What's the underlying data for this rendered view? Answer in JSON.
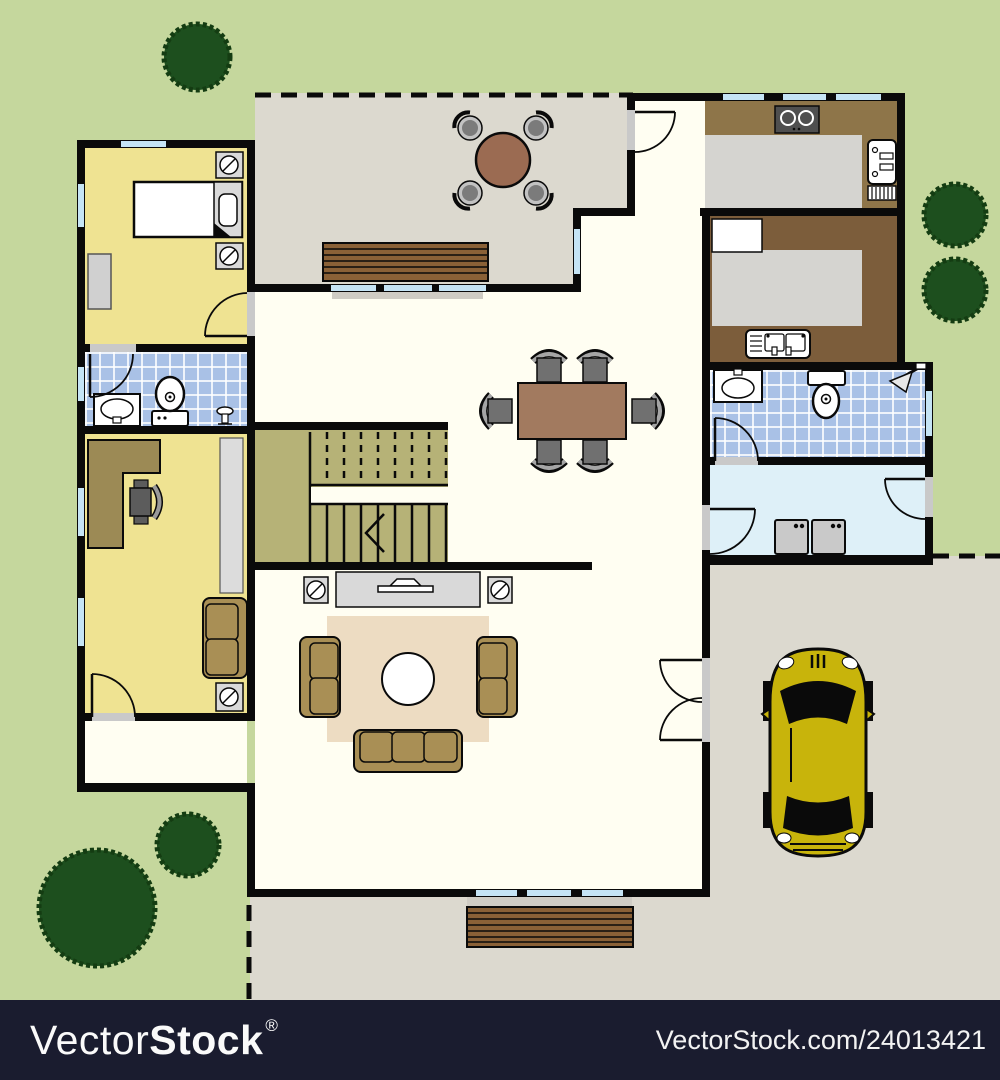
{
  "watermark": {
    "brand_light": "Vector",
    "brand_bold": "Stock",
    "registered_mark": "®",
    "site_credit": "VectorStock.com/24013421"
  },
  "colors": {
    "yard-green": "#c5d79d",
    "tree-green": "#1d4f1e",
    "tree-edge": "#143c12",
    "paving-gray": "#dcd9cf",
    "floor-ivory": "#fffef2",
    "room-yellow": "#efe392",
    "tile-blue": "#a9c1e6",
    "laundry-blue": "#def0f8",
    "stairs-khaki": "#b6b277",
    "counter-brown": "#8e7549",
    "pantry-brown": "#7c5d3b",
    "wood-brown": "#8a6137",
    "table-brown": "#a27a5f",
    "patio-table-brown": "#9b6b52",
    "sofa-tan": "#a98f55",
    "rug-beige": "#eddcc2",
    "furniture-gray": "#d9d9d9",
    "chair-gray": "#707070",
    "window-blue": "#c5e4f5",
    "wall-black": "#0a0a0a",
    "car-yellow": "#c8b40b",
    "watermark-navy": "#1a1c2f"
  },
  "floorplan": {
    "type": "ground-floor-architecture-plan",
    "rooms": [
      {
        "name": "bedroom",
        "furniture": [
          "bed",
          "nightstand-lamp",
          "nightstand-lamp",
          "dresser"
        ]
      },
      {
        "name": "ensuite-bathroom",
        "furniture": [
          "vanity-sink",
          "toilet",
          "bidet"
        ]
      },
      {
        "name": "home-office",
        "furniture": [
          "l-shaped-desk",
          "office-chair",
          "shelf",
          "loveseat",
          "lamp-table"
        ]
      },
      {
        "name": "patio",
        "furniture": [
          "round-table",
          "chair",
          "chair",
          "chair",
          "chair",
          "bench"
        ]
      },
      {
        "name": "dining-hall",
        "furniture": [
          "dining-table",
          "chair",
          "chair",
          "chair",
          "chair",
          "chair",
          "chair"
        ]
      },
      {
        "name": "staircase",
        "furniture": [
          "up-arrow"
        ]
      },
      {
        "name": "living-room",
        "furniture": [
          "tv-console",
          "lamp-table",
          "lamp-table",
          "rug",
          "coffee-table",
          "loveseat",
          "loveseat",
          "sofa"
        ]
      },
      {
        "name": "kitchen",
        "furniture": [
          "stove",
          "counter",
          "fridge"
        ]
      },
      {
        "name": "second-kitchen",
        "furniture": [
          "cabinet",
          "counter",
          "double-sink"
        ]
      },
      {
        "name": "bathroom",
        "furniture": [
          "sink",
          "toilet",
          "shower"
        ]
      },
      {
        "name": "laundry",
        "furniture": [
          "washer",
          "dryer"
        ]
      },
      {
        "name": "driveway",
        "furniture": [
          "car"
        ]
      },
      {
        "name": "front-entry",
        "furniture": [
          "deck-steps"
        ]
      },
      {
        "name": "yard",
        "furniture": [
          "tree",
          "tree",
          "tree",
          "tree",
          "tree"
        ]
      }
    ]
  }
}
